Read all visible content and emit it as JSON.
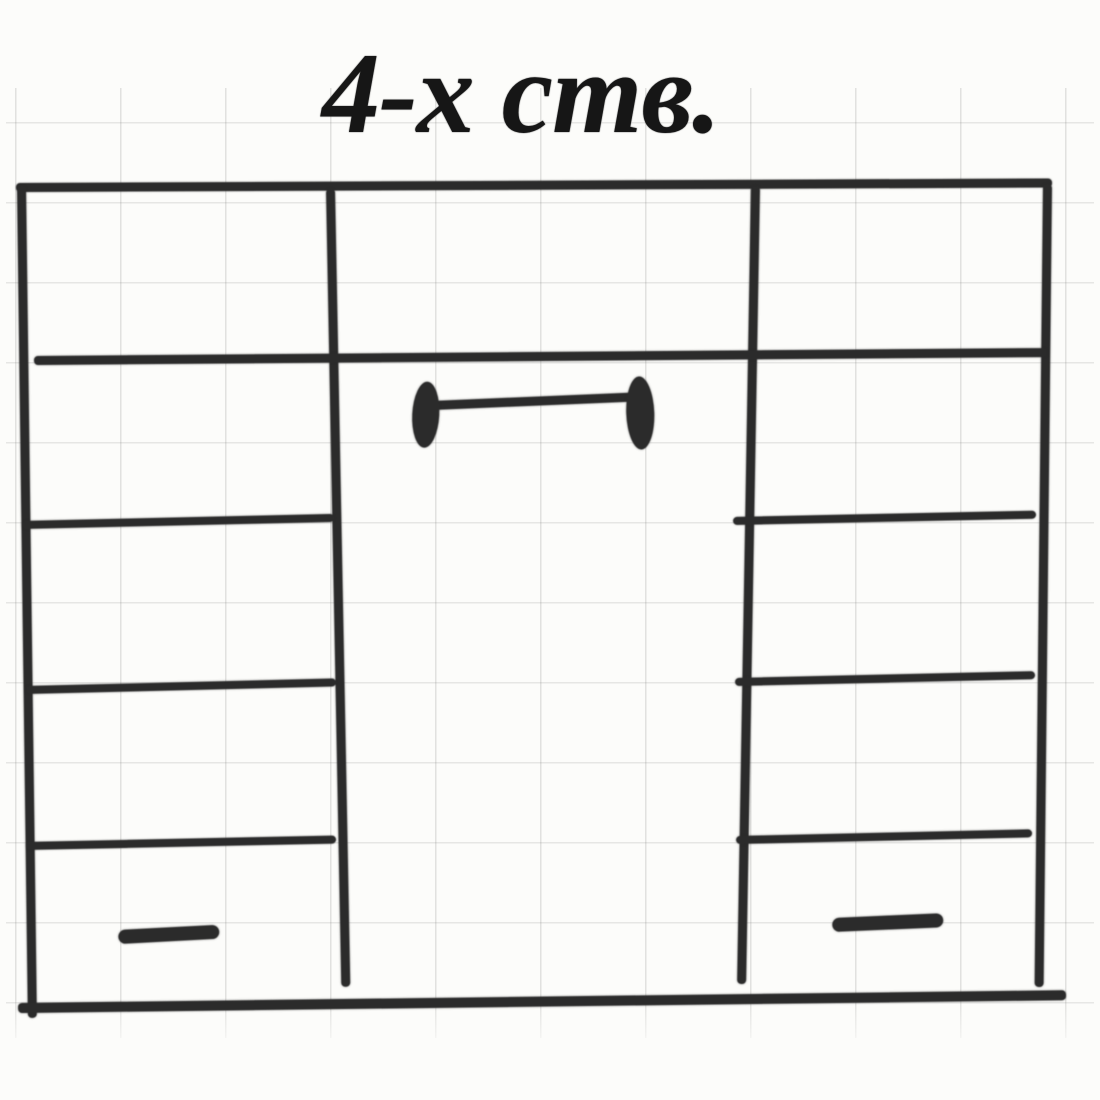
{
  "title": "4-х ств.",
  "paper": {
    "background": "#fcfcfa",
    "grid_color_vertical": "rgba(115,115,115,0.22)",
    "grid_color_horizontal": "rgba(115,115,115,0.18)",
    "grid_spacing_x": 105,
    "grid_spacing_y": 80,
    "grid_offset_x": 9,
    "grid_offset_y": 34
  },
  "ink": {
    "color": "#2b2b2b"
  },
  "diagram": {
    "description": "hand-drawn front elevation sketch of a 4-door wardrobe with side shelf columns, bottom drawers and a wide center double-door section",
    "elements": [
      {
        "name": "cabinet-top-border",
        "kind": "bar",
        "x": 16,
        "y": 183,
        "w": 1036,
        "h": 9,
        "a": -0.25
      },
      {
        "name": "cabinet-left-border",
        "kind": "bar",
        "x": 17,
        "y": 186,
        "w": 9,
        "h": 832,
        "a": -0.75
      },
      {
        "name": "cabinet-right-border",
        "kind": "bar",
        "x": 1043,
        "y": 184,
        "w": 9,
        "h": 803,
        "a": 0.6
      },
      {
        "name": "cabinet-bottom-border",
        "kind": "bar",
        "x": 18,
        "y": 1003,
        "w": 1048,
        "h": 10,
        "a": -0.7
      },
      {
        "name": "left-section-divider",
        "kind": "bar",
        "x": 326,
        "y": 189,
        "w": 9,
        "h": 798,
        "a": -1.1
      },
      {
        "name": "right-section-divider",
        "kind": "bar",
        "x": 751,
        "y": 186,
        "w": 9,
        "h": 798,
        "a": 1.0
      },
      {
        "name": "top-shelf-full-width",
        "kind": "bar",
        "x": 34,
        "y": 356,
        "w": 1013,
        "h": 9,
        "a": -0.45
      },
      {
        "name": "left-column-shelf-upper",
        "kind": "bar",
        "x": 22,
        "y": 521,
        "w": 312,
        "h": 8,
        "a": -1.3
      },
      {
        "name": "left-column-shelf-middle",
        "kind": "bar",
        "x": 26,
        "y": 686,
        "w": 310,
        "h": 8,
        "a": -1.4
      },
      {
        "name": "left-column-shelf-lower",
        "kind": "bar",
        "x": 26,
        "y": 842,
        "w": 310,
        "h": 8,
        "a": -1.2
      },
      {
        "name": "right-column-shelf-upper",
        "kind": "bar",
        "x": 733,
        "y": 517,
        "w": 303,
        "h": 8,
        "a": -1.2
      },
      {
        "name": "right-column-shelf-middle",
        "kind": "bar",
        "x": 735,
        "y": 678,
        "w": 300,
        "h": 8,
        "a": -1.3
      },
      {
        "name": "right-column-shelf-lower",
        "kind": "bar",
        "x": 736,
        "y": 836,
        "w": 296,
        "h": 8,
        "a": -1.3
      },
      {
        "name": "center-door-handle-bar",
        "kind": "bar",
        "x": 431,
        "y": 401,
        "w": 208,
        "h": 9,
        "a": -2.4
      },
      {
        "name": "center-door-handle-cap-left",
        "kind": "cap",
        "x": 414,
        "y": 381,
        "w": 27,
        "h": 66,
        "a": 3
      },
      {
        "name": "center-door-handle-cap-right",
        "kind": "cap",
        "x": 625,
        "y": 377,
        "w": 28,
        "h": 73,
        "a": -2
      },
      {
        "name": "left-drawer-handle",
        "kind": "knob",
        "x": 118,
        "y": 930,
        "w": 101,
        "h": 14,
        "a": -3
      },
      {
        "name": "right-drawer-handle",
        "kind": "knob",
        "x": 832,
        "y": 918,
        "w": 111,
        "h": 14,
        "a": -2.5
      }
    ]
  }
}
